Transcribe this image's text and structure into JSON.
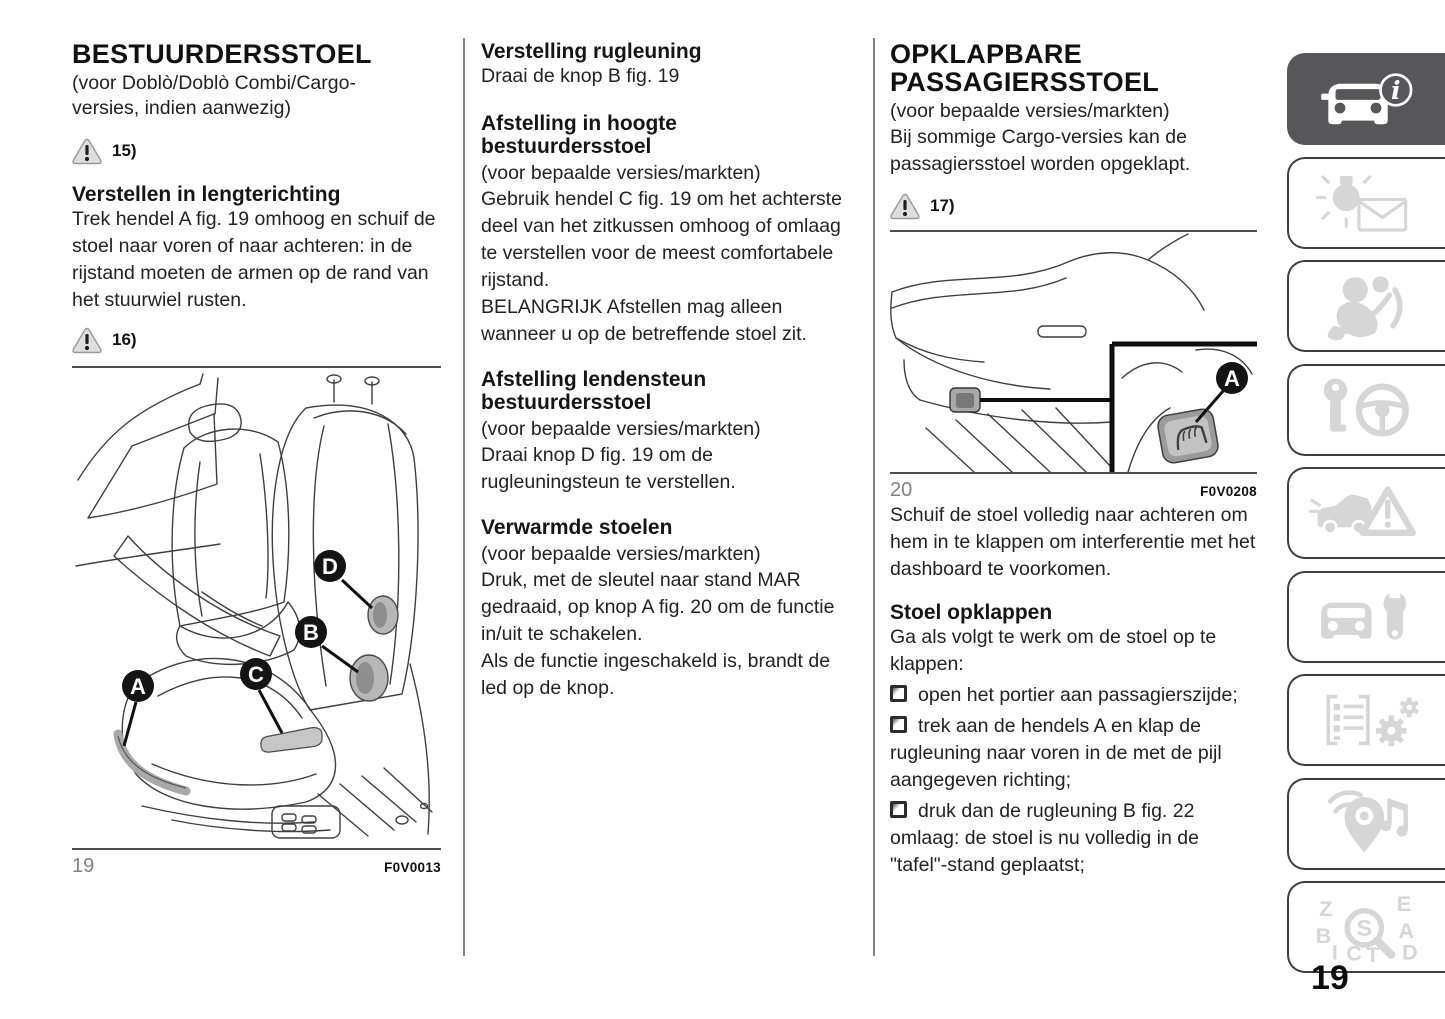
{
  "page": {
    "number": "19"
  },
  "colors": {
    "active_tab": "#57575a",
    "inactive_icon": "#d6d6d6",
    "callout": "#141414"
  },
  "left": {
    "title": "BESTUURDERSSTOEL",
    "title_note": "(voor Doblò/Doblò Combi/Cargo-\nversies, indien aanwezig)",
    "warning_1": "15)",
    "section_title": "Verstellen in lengterichting",
    "section_body": "Trek hendel A fig. 19 omhoog en schuif de stoel naar voren of naar achteren: in de rijstand moeten de armen op de rand van het stuurwiel rusten.",
    "warning_2": "16)",
    "figure": {
      "number": "19",
      "code": "F0V0013",
      "callout_a": "A",
      "callout_b": "B",
      "callout_c": "C",
      "callout_d": "D"
    }
  },
  "middle": {
    "s1_title": "Verstelling rugleuning",
    "s1_body": "Draai de knop B fig. 19",
    "s2_title": "Afstelling in hoogte\nbestuurdersstoel",
    "s2_note": "(voor bepaalde versies/markten)",
    "s2_body": "Gebruik hendel C fig. 19 om het achterste deel van het zitkussen omhoog of omlaag te verstellen voor de meest comfortabele rijstand.",
    "s2_important": "BELANGRIJK Afstellen mag alleen wanneer u op de betreffende stoel zit.",
    "s3_title": "Afstelling lendensteun\nbestuurdersstoel",
    "s3_note": "(voor bepaalde versies/markten)",
    "s3_body": "Draai knop D fig. 19 om de rugleuningsteun te verstellen.",
    "s4_title": "Verwarmde stoelen",
    "s4_note": "(voor bepaalde versies/markten)",
    "s4_body": "Druk, met de sleutel naar stand MAR gedraaid, op knop A fig. 20 om de functie in/uit te schakelen.\nAls de functie ingeschakeld is, brandt de led op de knop."
  },
  "right": {
    "title": "OPKLAPBARE\nPASSAGIERSSTOEL",
    "title_note": "(voor bepaalde versies/markten)",
    "intro": "Bij sommige Cargo-versies kan de passagiersstoel worden opgeklapt.",
    "warning_1": "17)",
    "figure": {
      "number": "20",
      "code": "F0V0208",
      "callout_a": "A"
    },
    "para_after_figure": "Schuif de stoel volledig naar achteren om hem in te klappen om interferentie met het dashboard te voorkomen.",
    "section_title": "Stoel opklappen",
    "section_intro": "Ga als volgt te werk om de stoel op te klappen:",
    "bullets": [
      "open het portier aan passagierszijde;",
      "trek aan de hendels A en klap de rugleuning naar voren in de met de pijl aangegeven richting;",
      "druk dan de rugleuning B fig. 22 omlaag: de stoel is nu volledig in de \"tafel\"-stand geplaatst;"
    ]
  },
  "sidebar": {
    "tabs": [
      {
        "icon": "vehicle-info-icon",
        "active": true
      },
      {
        "icon": "dashboard-lights-messages-icon",
        "active": false
      },
      {
        "icon": "safety-icon",
        "active": false
      },
      {
        "icon": "starting-driving-icon",
        "active": false
      },
      {
        "icon": "emergency-icon",
        "active": false
      },
      {
        "icon": "maintenance-icon",
        "active": false
      },
      {
        "icon": "technical-data-icon",
        "active": false
      },
      {
        "icon": "multimedia-icon",
        "active": false
      },
      {
        "icon": "index-icon",
        "active": false
      }
    ]
  }
}
